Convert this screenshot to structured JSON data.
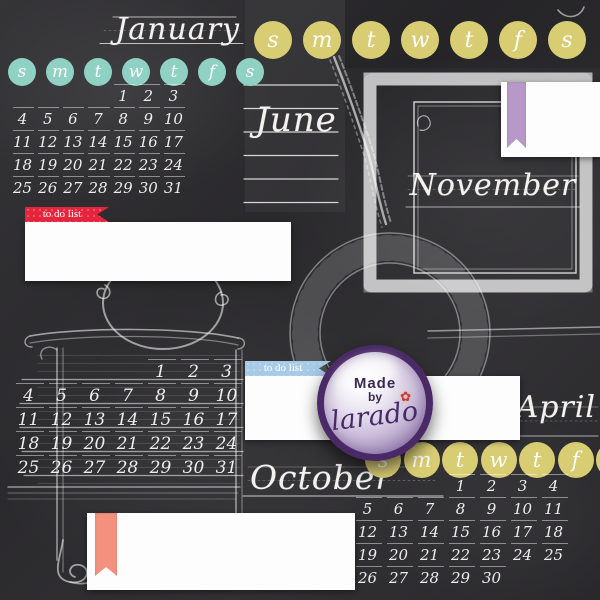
{
  "palette": {
    "board": "#2e2d30",
    "chalk": "#f3f2ef",
    "teal": "#8fd2c4",
    "yellow": "#d9cd74",
    "red": "#e6253c",
    "blue": "#a7cae6",
    "purple": "#b699c7",
    "coral": "#f3907e",
    "ring": "#4a2a66",
    "badgetext": "#3a2a55"
  },
  "day_headers": [
    "s",
    "m",
    "t",
    "w",
    "t",
    "f",
    "s"
  ],
  "months": {
    "january": {
      "title": "January",
      "weeks": [
        [
          "",
          "",
          "",
          "",
          "1",
          "2",
          "3"
        ],
        [
          "4",
          "5",
          "6",
          "7",
          "8",
          "9",
          "10"
        ],
        [
          "11",
          "12",
          "13",
          "14",
          "15",
          "16",
          "17"
        ],
        [
          "18",
          "19",
          "20",
          "21",
          "22",
          "23",
          "24"
        ],
        [
          "25",
          "26",
          "27",
          "28",
          "29",
          "30",
          "31"
        ]
      ]
    },
    "june": {
      "title": "June"
    },
    "november": {
      "title": "November"
    },
    "october": {
      "title": "October"
    },
    "april": {
      "title": "April",
      "weeks": [
        [
          "",
          "",
          "",
          "1",
          "2",
          "3",
          "4"
        ],
        [
          "5",
          "6",
          "7",
          "8",
          "9",
          "10",
          "11"
        ],
        [
          "12",
          "13",
          "14",
          "15",
          "16",
          "17",
          "18"
        ],
        [
          "19",
          "20",
          "21",
          "22",
          "23",
          "24",
          "25"
        ],
        [
          "26",
          "27",
          "28",
          "29",
          "30",
          "",
          ""
        ]
      ]
    },
    "untitled": {
      "weeks": [
        [
          "",
          "",
          "",
          "",
          "1",
          "2",
          "3"
        ],
        [
          "4",
          "5",
          "6",
          "7",
          "8",
          "9",
          "10"
        ],
        [
          "11",
          "12",
          "13",
          "14",
          "15",
          "16",
          "17"
        ],
        [
          "18",
          "19",
          "20",
          "21",
          "22",
          "23",
          "24"
        ],
        [
          "25",
          "26",
          "27",
          "28",
          "29",
          "30",
          "31"
        ]
      ]
    }
  },
  "todo": {
    "label": "to do list"
  },
  "badge": {
    "line1": "Made",
    "line2": "by",
    "brand": "larado"
  },
  "icons": {
    "flower": "✿"
  }
}
